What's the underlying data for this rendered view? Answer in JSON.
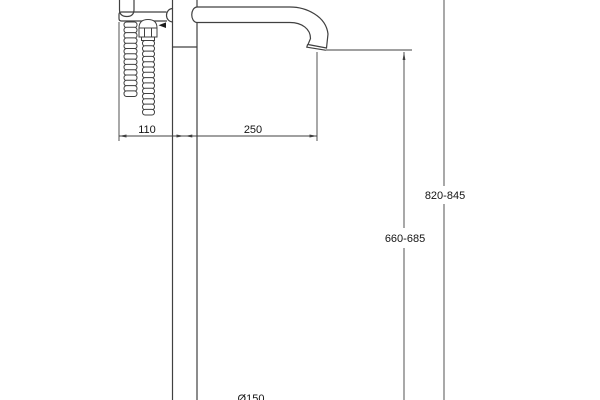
{
  "drawing": {
    "dimensions": {
      "hose_offset_mm": "110",
      "spout_reach_mm": "250",
      "overall_height_mm": "820-845",
      "spout_outlet_height_mm": "660-685",
      "base_diameter_mm": "Ø150"
    },
    "colors": {
      "line": "#404040",
      "text": "#141414",
      "background": "#ffffff"
    }
  }
}
